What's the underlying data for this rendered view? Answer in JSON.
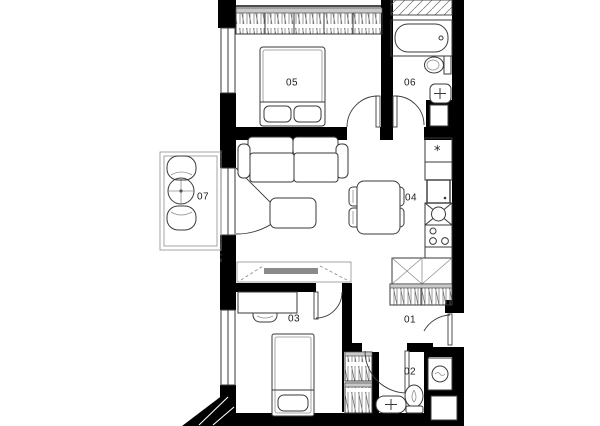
{
  "colors": {
    "wall": "#000000",
    "line": "#3a3a3a",
    "light": "#8f8f8f",
    "fill": "#c9c9c9",
    "background": "#ffffff",
    "label": "#1c1c1c"
  },
  "rooms": {
    "r01": {
      "label": "01"
    },
    "r02": {
      "label": "02"
    },
    "r03": {
      "label": "03"
    },
    "r04": {
      "label": "04"
    },
    "r05": {
      "label": "05"
    },
    "r06": {
      "label": "06"
    },
    "r07": {
      "label": "07"
    }
  },
  "kitchen": {
    "fridge_symbol": "*"
  }
}
